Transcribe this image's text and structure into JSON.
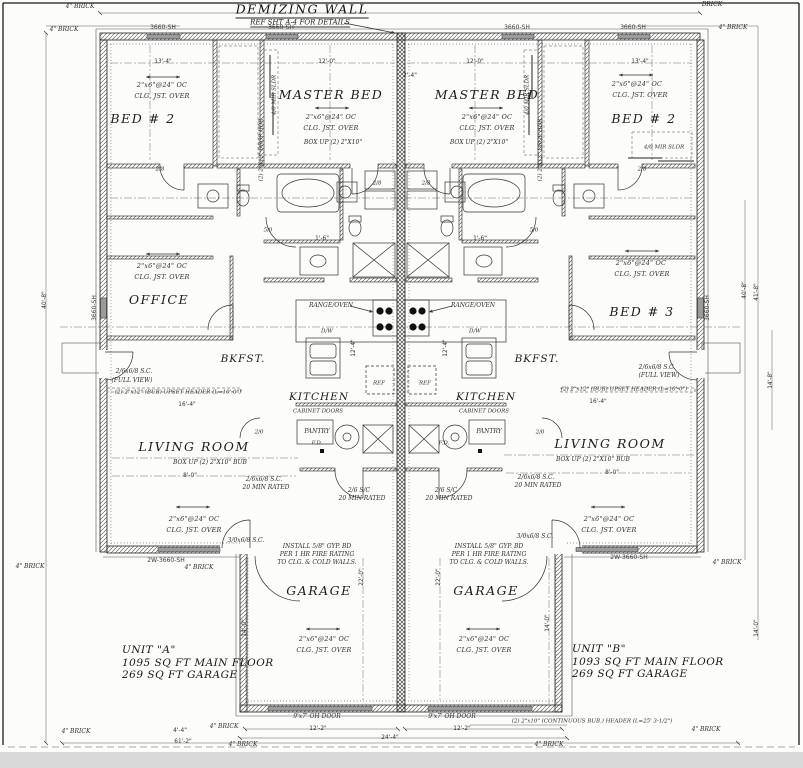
{
  "drawing": {
    "demising_wall_label": "DEMIZING WALL",
    "demising_wall_ref": "REF SHT A-4 FOR DETAILS",
    "units": {
      "a": {
        "name": "UNIT \"A\"",
        "main_floor": "1095 SQ FT MAIN FLOOR",
        "garage": "269 SQ FT GARAGE"
      },
      "b": {
        "name": "UNIT \"B\"",
        "main_floor": "1093 SQ FT MAIN FLOOR",
        "garage": "269 SQ FT GARAGE"
      }
    },
    "colors": {
      "ink": "#2e2e2e",
      "paper": "#fcfcfa",
      "window_fill": "#9b9b9b",
      "scan_edge": "#d9d9d9"
    }
  },
  "labels": [
    {
      "name": "window-tag",
      "text": "3660-SH",
      "x": 163,
      "y": 28,
      "cls": "tag"
    },
    {
      "name": "window-tag",
      "text": "3660-SH",
      "x": 281,
      "y": 28,
      "cls": "tag"
    },
    {
      "name": "window-tag",
      "text": "3660-SH",
      "x": 517,
      "y": 28,
      "cls": "tag"
    },
    {
      "name": "window-tag",
      "text": "3660-SH",
      "x": 633,
      "y": 28,
      "cls": "tag"
    },
    {
      "name": "window-tag",
      "text": "3660-SH",
      "x": 95,
      "y": 308,
      "cls": "tag",
      "rot": -90
    },
    {
      "name": "window-tag",
      "text": "3660-SH",
      "x": 708,
      "y": 308,
      "cls": "tag",
      "rot": -90
    },
    {
      "name": "window-tag",
      "text": "2W-3660-SH",
      "x": 166,
      "y": 561,
      "cls": "tag"
    },
    {
      "name": "window-tag",
      "text": "2W-3660-SH",
      "x": 629,
      "y": 558,
      "cls": "tag"
    },
    {
      "name": "brick-note",
      "text": "4\" BRICK",
      "x": 80,
      "y": 7,
      "cls": "tiny"
    },
    {
      "name": "brick-note",
      "text": "4\" BRICK",
      "x": 64,
      "y": 30,
      "cls": "tiny"
    },
    {
      "name": "brick-note",
      "text": "BRICK",
      "x": 712,
      "y": 5,
      "cls": "tiny"
    },
    {
      "name": "brick-note",
      "text": "4\" BRICK",
      "x": 733,
      "y": 28,
      "cls": "tiny"
    },
    {
      "name": "brick-note",
      "text": "4\" BRICK",
      "x": 30,
      "y": 567,
      "cls": "tiny"
    },
    {
      "name": "brick-note",
      "text": "4\" BRICK",
      "x": 199,
      "y": 568,
      "cls": "tiny"
    },
    {
      "name": "brick-note",
      "text": "4\" BRICK",
      "x": 727,
      "y": 563,
      "cls": "tiny"
    },
    {
      "name": "brick-note",
      "text": "4\" BRICK",
      "x": 76,
      "y": 732,
      "cls": "tiny"
    },
    {
      "name": "brick-note",
      "text": "4\" BRICK",
      "x": 224,
      "y": 727,
      "cls": "tiny"
    },
    {
      "name": "brick-note",
      "text": "4\" BRICK",
      "x": 243,
      "y": 745,
      "cls": "tiny"
    },
    {
      "name": "brick-note",
      "text": "4\" BRICK",
      "x": 549,
      "y": 745,
      "cls": "tiny"
    },
    {
      "name": "brick-note",
      "text": "4\" BRICK",
      "x": 706,
      "y": 730,
      "cls": "tiny"
    },
    {
      "name": "room-bed2-a",
      "text": "BED # 2",
      "x": 143,
      "y": 119,
      "cls": "room"
    },
    {
      "name": "joist-note",
      "text": "2\"x6\"@24\" OC",
      "x": 162,
      "y": 85,
      "cls": "note"
    },
    {
      "name": "joist-note",
      "text": "CLG. JST. OVER",
      "x": 162,
      "y": 96,
      "cls": "note"
    },
    {
      "name": "room-master-a",
      "text": "MASTER BED",
      "x": 331,
      "y": 95,
      "cls": "room"
    },
    {
      "name": "joist-note",
      "text": "2\"x6\"@24\" OC",
      "x": 331,
      "y": 117,
      "cls": "note"
    },
    {
      "name": "joist-note",
      "text": "CLG. JST. OVER",
      "x": 331,
      "y": 128,
      "cls": "note"
    },
    {
      "name": "box-up-note",
      "text": "BOX UP (2) 2\"X10\"",
      "x": 333,
      "y": 143,
      "cls": "tiny"
    },
    {
      "name": "room-office-a",
      "text": "OFFICE",
      "x": 159,
      "y": 300,
      "cls": "room"
    },
    {
      "name": "joist-note",
      "text": "2\"x6\"@24\" OC",
      "x": 162,
      "y": 266,
      "cls": "note"
    },
    {
      "name": "joist-note",
      "text": "CLG. JST. OVER",
      "x": 162,
      "y": 277,
      "cls": "note"
    },
    {
      "name": "room-bkfst-a",
      "text": "BKFST.",
      "x": 243,
      "y": 359,
      "cls": "room-sm"
    },
    {
      "name": "room-kitchen-a",
      "text": "KITCHEN",
      "x": 319,
      "y": 397,
      "cls": "room-sm"
    },
    {
      "name": "range-oven-note",
      "text": "RANGE/OVEN",
      "x": 331,
      "y": 306,
      "cls": "tiny"
    },
    {
      "name": "dishwasher-note",
      "text": "D/W",
      "x": 327,
      "y": 332,
      "cls": "tiny5"
    },
    {
      "name": "fridge-note",
      "text": "REF",
      "x": 379,
      "y": 384,
      "cls": "tiny5"
    },
    {
      "name": "cabinet-note",
      "text": "CABINET DOORS",
      "x": 318,
      "y": 412,
      "cls": "tiny5"
    },
    {
      "name": "room-pantry-a",
      "text": "PANTRY",
      "x": 317,
      "y": 432,
      "cls": "tiny"
    },
    {
      "name": "floor-drain-note",
      "text": "F.D.",
      "x": 317,
      "y": 444,
      "cls": "tiny5"
    },
    {
      "name": "room-living-a",
      "text": "LIVING ROOM",
      "x": 194,
      "y": 447,
      "cls": "room"
    },
    {
      "name": "box-up-note",
      "text": "BOX UP (2) 2\"X10\" BUB",
      "x": 210,
      "y": 463,
      "cls": "tiny"
    },
    {
      "name": "joist-note",
      "text": "2\"x6\"@24\" OC",
      "x": 194,
      "y": 519,
      "cls": "note"
    },
    {
      "name": "joist-note",
      "text": "CLG. JST. OVER",
      "x": 194,
      "y": 530,
      "cls": "note"
    },
    {
      "name": "door-note",
      "text": "2/6x6/8 S.C.",
      "x": 264,
      "y": 480,
      "cls": "tiny"
    },
    {
      "name": "door-note",
      "text": "20 MIN RATED",
      "x": 266,
      "y": 488,
      "cls": "tiny"
    },
    {
      "name": "door-note",
      "text": "2/6 S/C",
      "x": 359,
      "y": 491,
      "cls": "tiny"
    },
    {
      "name": "door-note",
      "text": "20 MIN RATED",
      "x": 362,
      "y": 499,
      "cls": "tiny"
    },
    {
      "name": "door-note",
      "text": "3/0x6/8 S.C.",
      "x": 246,
      "y": 541,
      "cls": "tiny"
    },
    {
      "name": "door-note",
      "text": "2/6x6/8 S.C.",
      "x": 134,
      "y": 372,
      "cls": "tiny"
    },
    {
      "name": "door-note",
      "text": "(FULL VIEW)",
      "x": 132,
      "y": 381,
      "cls": "tiny"
    },
    {
      "name": "header-note",
      "text": "(2) 2\"x12\" (BUB) UPSET HEADER (L=10'-0\")",
      "x": 178,
      "y": 393,
      "cls": "tiny5"
    },
    {
      "name": "fire-rating-note",
      "text": "INSTALL 5/8\" GYP. BD",
      "x": 317,
      "y": 547,
      "cls": "tiny"
    },
    {
      "name": "fire-rating-note",
      "text": "PER 1 HR FIRE RATING",
      "x": 317,
      "y": 555,
      "cls": "tiny"
    },
    {
      "name": "fire-rating-note",
      "text": "TO CLG. & COLD WALLS.",
      "x": 317,
      "y": 563,
      "cls": "tiny"
    },
    {
      "name": "room-garage-a",
      "text": "GARAGE",
      "x": 319,
      "y": 591,
      "cls": "room"
    },
    {
      "name": "joist-note",
      "text": "2\"x6\"@24\" OC",
      "x": 324,
      "y": 639,
      "cls": "note"
    },
    {
      "name": "joist-note",
      "text": "CLG. JST. OVER",
      "x": 324,
      "y": 650,
      "cls": "note"
    },
    {
      "name": "oh-door-note",
      "text": "9'x7' OH DOOR",
      "x": 317,
      "y": 717,
      "cls": "tiny"
    },
    {
      "name": "drop-hdr-note",
      "text": "(2) 2\"X12\" DROP HDR",
      "x": 262,
      "y": 150,
      "cls": "tiny5",
      "rot": -90
    },
    {
      "name": "mir-sldr-note",
      "text": "4/0 MIR SLDR",
      "x": 275,
      "y": 95,
      "cls": "tiny5",
      "rot": -90
    },
    {
      "name": "door-tag",
      "text": "5/0",
      "x": 268,
      "y": 231,
      "cls": "tiny5"
    },
    {
      "name": "door-tag",
      "text": "2/8",
      "x": 377,
      "y": 184,
      "cls": "tiny5"
    },
    {
      "name": "door-tag",
      "text": "2/8",
      "x": 160,
      "y": 170,
      "cls": "tiny5"
    },
    {
      "name": "door-tag",
      "text": "2/0",
      "x": 259,
      "y": 433,
      "cls": "tiny5"
    },
    {
      "name": "dim",
      "text": "14'-0\"",
      "x": 246,
      "y": 628,
      "cls": "dim",
      "rot": -90
    },
    {
      "name": "dim",
      "text": "22'-0\"",
      "x": 363,
      "y": 577,
      "cls": "dim",
      "rot": -90
    },
    {
      "name": "room-master-b",
      "text": "MASTER BED",
      "x": 487,
      "y": 95,
      "cls": "room"
    },
    {
      "name": "joist-note",
      "text": "2\"x6\"@24\" OC",
      "x": 487,
      "y": 117,
      "cls": "note"
    },
    {
      "name": "joist-note",
      "text": "CLG. JST. OVER",
      "x": 487,
      "y": 128,
      "cls": "note"
    },
    {
      "name": "box-up-note",
      "text": "BOX UP (2) 2\"X10\"",
      "x": 479,
      "y": 143,
      "cls": "tiny"
    },
    {
      "name": "room-bed2-b",
      "text": "BED # 2",
      "x": 644,
      "y": 119,
      "cls": "room"
    },
    {
      "name": "joist-note",
      "text": "2\"x6\"@24\" OC",
      "x": 637,
      "y": 84,
      "cls": "note"
    },
    {
      "name": "joist-note",
      "text": "CLG. JST. OVER",
      "x": 640,
      "y": 95,
      "cls": "note"
    },
    {
      "name": "mir-sldr-note",
      "text": "4/0 MIR SLDR",
      "x": 664,
      "y": 148,
      "cls": "tiny5"
    },
    {
      "name": "room-bed3-b",
      "text": "BED # 3",
      "x": 642,
      "y": 312,
      "cls": "room"
    },
    {
      "name": "joist-note",
      "text": "2\"x6\"@24\" OC",
      "x": 641,
      "y": 263,
      "cls": "note"
    },
    {
      "name": "joist-note",
      "text": "CLG. JST. OVER",
      "x": 642,
      "y": 274,
      "cls": "note"
    },
    {
      "name": "room-bkfst-b",
      "text": "BKFST.",
      "x": 537,
      "y": 359,
      "cls": "room-sm"
    },
    {
      "name": "room-kitchen-b",
      "text": "KITCHEN",
      "x": 486,
      "y": 397,
      "cls": "room-sm"
    },
    {
      "name": "range-oven-note",
      "text": "RANGE/OVEN",
      "x": 473,
      "y": 306,
      "cls": "tiny"
    },
    {
      "name": "dishwasher-note",
      "text": "D/W",
      "x": 475,
      "y": 332,
      "cls": "tiny5"
    },
    {
      "name": "fridge-note",
      "text": "REF",
      "x": 425,
      "y": 384,
      "cls": "tiny5"
    },
    {
      "name": "cabinet-note",
      "text": "CABINET DOORS",
      "x": 484,
      "y": 412,
      "cls": "tiny5"
    },
    {
      "name": "room-pantry-b",
      "text": "PANTRY",
      "x": 489,
      "y": 432,
      "cls": "tiny"
    },
    {
      "name": "floor-drain-note",
      "text": "F.D.",
      "x": 444,
      "y": 444,
      "cls": "tiny5"
    },
    {
      "name": "room-living-b",
      "text": "LIVING ROOM",
      "x": 610,
      "y": 444,
      "cls": "room"
    },
    {
      "name": "box-up-note",
      "text": "BOX UP (2) 2\"X10\" BUB",
      "x": 593,
      "y": 460,
      "cls": "tiny"
    },
    {
      "name": "joist-note",
      "text": "2\"x6\"@24\" OC",
      "x": 609,
      "y": 519,
      "cls": "note"
    },
    {
      "name": "joist-note",
      "text": "CLG. JST. OVER",
      "x": 609,
      "y": 530,
      "cls": "note"
    },
    {
      "name": "door-note",
      "text": "2/6x6/8 S.C.",
      "x": 536,
      "y": 478,
      "cls": "tiny"
    },
    {
      "name": "door-note",
      "text": "20 MIN RATED",
      "x": 538,
      "y": 486,
      "cls": "tiny"
    },
    {
      "name": "door-note",
      "text": "2/6 S/C",
      "x": 446,
      "y": 491,
      "cls": "tiny"
    },
    {
      "name": "door-note",
      "text": "20 MIN RATED",
      "x": 449,
      "y": 499,
      "cls": "tiny"
    },
    {
      "name": "door-note",
      "text": "3/0x6/8 S.C.",
      "x": 535,
      "y": 537,
      "cls": "tiny"
    },
    {
      "name": "door-note",
      "text": "2/6x6/8 S.C.",
      "x": 657,
      "y": 368,
      "cls": "tiny"
    },
    {
      "name": "door-note",
      "text": "(FULL VIEW)",
      "x": 659,
      "y": 376,
      "cls": "tiny"
    },
    {
      "name": "header-note",
      "text": "(2) 2\"x12\" (BUB) UPSET HEADER (L=10'-0\")",
      "x": 624,
      "y": 390,
      "cls": "tiny5"
    },
    {
      "name": "fire-rating-note",
      "text": "INSTALL 5/8\" GYP. BD",
      "x": 489,
      "y": 547,
      "cls": "tiny"
    },
    {
      "name": "fire-rating-note",
      "text": "PER 1 HR FIRE RATING",
      "x": 489,
      "y": 555,
      "cls": "tiny"
    },
    {
      "name": "fire-rating-note",
      "text": "TO CLG. & COLD WALLS.",
      "x": 489,
      "y": 563,
      "cls": "tiny"
    },
    {
      "name": "room-garage-b",
      "text": "GARAGE",
      "x": 486,
      "y": 591,
      "cls": "room"
    },
    {
      "name": "joist-note",
      "text": "2\"x6\"@24\" OC",
      "x": 484,
      "y": 639,
      "cls": "note"
    },
    {
      "name": "joist-note",
      "text": "CLG. JST. OVER",
      "x": 484,
      "y": 650,
      "cls": "note"
    },
    {
      "name": "oh-door-note",
      "text": "9'x7' OH DOOR",
      "x": 452,
      "y": 717,
      "cls": "tiny"
    },
    {
      "name": "drop-hdr-note",
      "text": "(2) 2\"X12\" DROP HDR",
      "x": 541,
      "y": 150,
      "cls": "tiny5",
      "rot": -90
    },
    {
      "name": "mir-sldr-note",
      "text": "4/0 MIR SLDR",
      "x": 528,
      "y": 95,
      "cls": "tiny5",
      "rot": -90
    },
    {
      "name": "door-tag",
      "text": "5/0",
      "x": 534,
      "y": 231,
      "cls": "tiny5"
    },
    {
      "name": "door-tag",
      "text": "2/8",
      "x": 426,
      "y": 184,
      "cls": "tiny5"
    },
    {
      "name": "door-tag",
      "text": "2/8",
      "x": 642,
      "y": 170,
      "cls": "tiny5"
    },
    {
      "name": "door-tag",
      "text": "2/0",
      "x": 540,
      "y": 433,
      "cls": "tiny5"
    },
    {
      "name": "dim",
      "text": "14'-0\"",
      "x": 549,
      "y": 623,
      "cls": "dim",
      "rot": -90
    },
    {
      "name": "dim",
      "text": "22'-0\"",
      "x": 440,
      "y": 577,
      "cls": "dim",
      "rot": -90
    },
    {
      "name": "dim",
      "text": "14'-0\"",
      "x": 758,
      "y": 628,
      "cls": "dim",
      "rot": -90
    },
    {
      "name": "continuous-header-note",
      "text": "(2) 2\"x10\" (CONTINUOUS BUB.) HEADER (L=25' 3-1/2\")",
      "x": 592,
      "y": 722,
      "cls": "tiny5"
    },
    {
      "name": "dim",
      "text": "13'-4\"",
      "x": 163,
      "y": 63,
      "cls": "dim"
    },
    {
      "name": "dim",
      "text": "12'-0\"",
      "x": 327,
      "y": 63,
      "cls": "dim"
    },
    {
      "name": "dim",
      "text": "12'-0\"",
      "x": 475,
      "y": 63,
      "cls": "dim"
    },
    {
      "name": "dim",
      "text": "13'-4\"",
      "x": 640,
      "y": 63,
      "cls": "dim"
    },
    {
      "name": "dim",
      "text": "2'-4\"",
      "x": 410,
      "y": 77,
      "cls": "dim"
    },
    {
      "name": "dim",
      "text": "16'-4\"",
      "x": 187,
      "y": 406,
      "cls": "dim"
    },
    {
      "name": "dim",
      "text": "16'-4\"",
      "x": 598,
      "y": 403,
      "cls": "dim"
    },
    {
      "name": "dim",
      "text": "8'-0\"",
      "x": 190,
      "y": 477,
      "cls": "dim"
    },
    {
      "name": "dim",
      "text": "8'-0\"",
      "x": 612,
      "y": 474,
      "cls": "dim"
    },
    {
      "name": "dim",
      "text": "1'-6\"",
      "x": 322,
      "y": 240,
      "cls": "dim"
    },
    {
      "name": "dim",
      "text": "1'-6\"",
      "x": 480,
      "y": 240,
      "cls": "dim"
    },
    {
      "name": "dim",
      "text": "12'-4\"",
      "x": 355,
      "y": 348,
      "cls": "dim",
      "rot": -90
    },
    {
      "name": "dim",
      "text": "12'-4\"",
      "x": 447,
      "y": 348,
      "cls": "dim",
      "rot": -90
    },
    {
      "name": "dim",
      "text": "12'-2\"",
      "x": 318,
      "y": 730,
      "cls": "dim"
    },
    {
      "name": "dim",
      "text": "12'-2\"",
      "x": 462,
      "y": 730,
      "cls": "dim"
    },
    {
      "name": "dim",
      "text": "24'-4\"",
      "x": 390,
      "y": 739,
      "cls": "dim"
    },
    {
      "name": "dim",
      "text": "61'-2\"",
      "x": 183,
      "y": 743,
      "cls": "dim"
    },
    {
      "name": "dim",
      "text": "4'-4\"",
      "x": 180,
      "y": 732,
      "cls": "dim"
    },
    {
      "name": "dim",
      "text": "40'-8\"",
      "x": 746,
      "y": 290,
      "cls": "dim",
      "rot": -90
    },
    {
      "name": "dim",
      "text": "41'-8\"",
      "x": 758,
      "y": 292,
      "cls": "dim",
      "rot": -90
    },
    {
      "name": "dim",
      "text": "40'-8\"",
      "x": 46,
      "y": 300,
      "cls": "dim",
      "rot": -90
    },
    {
      "name": "dim",
      "text": "14'-8\"",
      "x": 772,
      "y": 380,
      "cls": "dim",
      "rot": -90
    }
  ]
}
